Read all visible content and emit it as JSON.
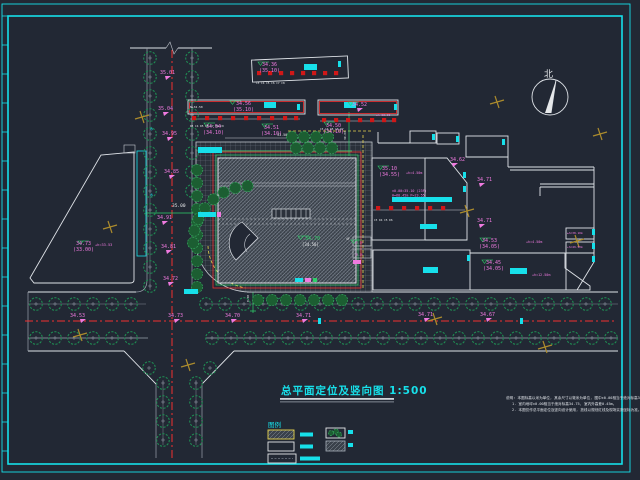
{
  "drawing": {
    "title": "总平面定位及竖向图",
    "scale": "1:500",
    "title_full": "总平面定位及竖向图 1:500",
    "north_label": "北",
    "legend_header": "图例",
    "notes": [
      "说明: 本图标高以米为单位, 其余尺寸以毫米为单位, 图中±0.00相当于绝对标高34.75m。",
      "1. 室内地坪±0.00相当于绝对标高34.75, 室内外高差0.45m。",
      "2. 本图仅作总平面定位及竖向设计使用, 放线以规划红线及现场实测坐标为准。"
    ],
    "building_floor_label": "4F",
    "colors": {
      "background": "#222834",
      "frame_cyan": "#17e0ea",
      "centerline_red": "#f23030",
      "annotation_magenta": "#f07ae0",
      "elevation_green": "#2fd06a",
      "tree_green": "#1f8a52",
      "survey_gold": "#ab8b2d",
      "curb_yellow": "#e8d44d"
    },
    "labels": [
      {
        "t": "35.01",
        "x": 160,
        "y": 74
      },
      {
        "t": "35.04",
        "x": 158,
        "y": 110
      },
      {
        "t": "34.95",
        "x": 162,
        "y": 135
      },
      {
        "t": "34.85",
        "x": 164,
        "y": 173
      },
      {
        "t": "35.00",
        "x": 172,
        "y": 207,
        "c": "w",
        "s": 4.5
      },
      {
        "t": "34.91",
        "x": 157,
        "y": 219
      },
      {
        "t": "34.81",
        "x": 161,
        "y": 248
      },
      {
        "t": "34.72",
        "x": 163,
        "y": 280
      },
      {
        "t": "34.53",
        "x": 70,
        "y": 317
      },
      {
        "t": "34.73",
        "x": 168,
        "y": 317
      },
      {
        "t": "34.70",
        "x": 225,
        "y": 317
      },
      {
        "t": "34.71",
        "x": 296,
        "y": 317
      },
      {
        "t": "34.71",
        "x": 418,
        "y": 316
      },
      {
        "t": "34.67",
        "x": 480,
        "y": 316
      },
      {
        "t": "34.73",
        "x": 76,
        "y": 245
      },
      {
        "t": "(33.00)",
        "x": 73,
        "y": 251
      },
      {
        "t": "+h=33.53",
        "x": 95,
        "y": 246,
        "s": 3.6
      },
      {
        "t": "34.36",
        "x": 262,
        "y": 66
      },
      {
        "t": "(35.10)",
        "x": 259,
        "y": 72
      },
      {
        "t": "34.56",
        "x": 236,
        "y": 105
      },
      {
        "t": "(35.10)",
        "x": 233,
        "y": 111
      },
      {
        "t": "N+34.50",
        "x": 190,
        "y": 108,
        "c": "w",
        "s": 3
      },
      {
        "t": "34.52",
        "x": 352,
        "y": 106
      },
      {
        "t": "±h=38.20",
        "x": 376,
        "y": 116,
        "s": 3
      },
      {
        "t": "34.54",
        "x": 206,
        "y": 128
      },
      {
        "t": "(34.10)",
        "x": 203,
        "y": 134
      },
      {
        "t": "34.51",
        "x": 264,
        "y": 129
      },
      {
        "t": "(34.10)",
        "x": 261,
        "y": 135
      },
      {
        "t": "34.50",
        "x": 326,
        "y": 127
      },
      {
        "t": "(34.10)",
        "x": 323,
        "y": 133
      },
      {
        "t": "35.10",
        "x": 382,
        "y": 170
      },
      {
        "t": "(34.55)",
        "x": 379,
        "y": 176
      },
      {
        "t": "+h=4.50m",
        "x": 406,
        "y": 174,
        "s": 3.4
      },
      {
        "t": "±0.00=35.10 (23F)",
        "x": 392,
        "y": 192,
        "s": 3.4
      },
      {
        "t": "H=68.45m P=23.55",
        "x": 392,
        "y": 196.5,
        "s": 3.4
      },
      {
        "t": "34.62",
        "x": 450,
        "y": 161
      },
      {
        "t": "34.71",
        "x": 477,
        "y": 181
      },
      {
        "t": "34.71",
        "x": 477,
        "y": 222
      },
      {
        "t": "34.53",
        "x": 482,
        "y": 242
      },
      {
        "t": "(34.05)",
        "x": 479,
        "y": 248
      },
      {
        "t": "+h=4.50m",
        "x": 526,
        "y": 243,
        "s": 3.4
      },
      {
        "t": "34.45",
        "x": 486,
        "y": 264
      },
      {
        "t": "(34.05)",
        "x": 483,
        "y": 270
      },
      {
        "t": "+h=12.50m",
        "x": 532,
        "y": 276,
        "s": 3.4
      },
      {
        "t": "±h=38.10m",
        "x": 567,
        "y": 234,
        "s": 2.9
      },
      {
        "t": "+h=49.50m",
        "x": 567,
        "y": 248,
        "s": 2.9
      },
      {
        "t": "34.70",
        "x": 305,
        "y": 240,
        "c": "g"
      },
      {
        "t": "[34.50]",
        "x": 302,
        "y": 246,
        "c": "w",
        "s": 4
      },
      {
        "t": "4F",
        "x": 346,
        "y": 240,
        "c": "w",
        "s": 3.2
      },
      {
        "t": "31.50",
        "x": 277,
        "y": 136,
        "c": "w",
        "s": 3.4
      },
      {
        "t": "39.60",
        "x": 346,
        "y": 140,
        "c": "w",
        "s": 3,
        "r": -90
      },
      {
        "t": "8.00",
        "x": 249,
        "y": 302,
        "c": "w",
        "s": 3,
        "r": -90
      },
      {
        "t": "35.10",
        "x": 355,
        "y": 243.5,
        "s": 2.6
      },
      {
        "t": "38.10",
        "x": 355,
        "y": 255.5,
        "s": 2.6
      },
      {
        "t": "C3 C4 C5 C6 C7 C8",
        "x": 256,
        "y": 84,
        "c": "w",
        "s": 2.8
      },
      {
        "t": "D3 C4 D5 C6 C7 D8 C9",
        "x": 190,
        "y": 127,
        "c": "w",
        "s": 2.8
      },
      {
        "t": "C3 C4 D5 C6 D7",
        "x": 320,
        "y": 130,
        "c": "w",
        "s": 2.8
      },
      {
        "t": "C3 D4 C5 D6",
        "x": 374,
        "y": 221,
        "c": "w",
        "s": 2.8
      },
      {
        "t": "水",
        "x": 150,
        "y": 130,
        "c": "c",
        "s": 3.2
      },
      {
        "t": "水",
        "x": 150,
        "y": 196,
        "c": "c",
        "s": 3.2
      }
    ]
  }
}
